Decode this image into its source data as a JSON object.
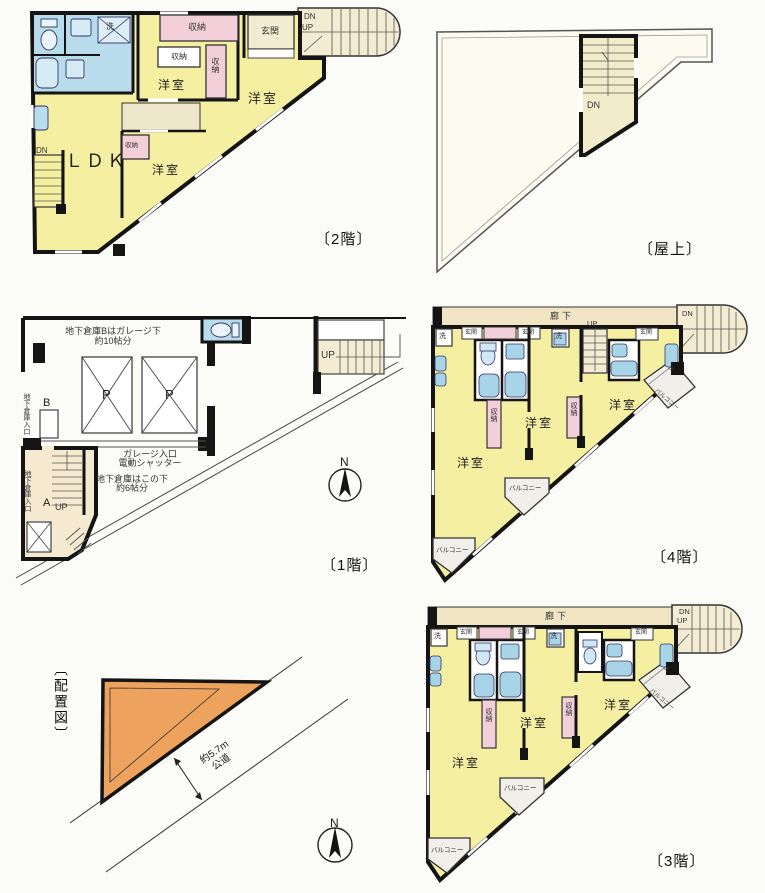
{
  "captions": {
    "floor2": "〔2階〕",
    "rooftop": "〔屋上〕",
    "floor1": "〔1階〕",
    "floor4": "〔4階〕",
    "floor3": "〔3階〕",
    "siteplan": "〔配置図〕"
  },
  "labels": {
    "ldk": "ＬＤＫ",
    "western_room": "洋室",
    "storage": "収納",
    "entrance": "玄関",
    "wash": "洗",
    "corridor": "廊下",
    "balcony": "バルコニー",
    "parking": "P",
    "up": "UP",
    "dn": "DN",
    "north": "N",
    "unit_a": "A",
    "unit_b": "B"
  },
  "floor1_texts": {
    "note_b_line1": "地下倉庫Bはガレージ下",
    "note_b_line2": "約10帖分",
    "garage_line1": "ガレージ入口",
    "garage_line2": "電動シャッター",
    "note_under_line1": "地下倉庫はこの下",
    "note_under_line2": "約6帖分",
    "basement_entrance": "地下倉庫入口"
  },
  "siteplan_texts": {
    "road_width": "約5.7m",
    "road_type": "公道"
  },
  "colors": {
    "room_yellow": "#f5efa2",
    "bath_blue": "#a8d4e8",
    "storage_pink": "#f2cfd9",
    "stair_beige": "#f3ecd2",
    "corridor_beige": "#f0e4c3",
    "site_orange": "#eda25e",
    "wall_black": "#141414"
  }
}
